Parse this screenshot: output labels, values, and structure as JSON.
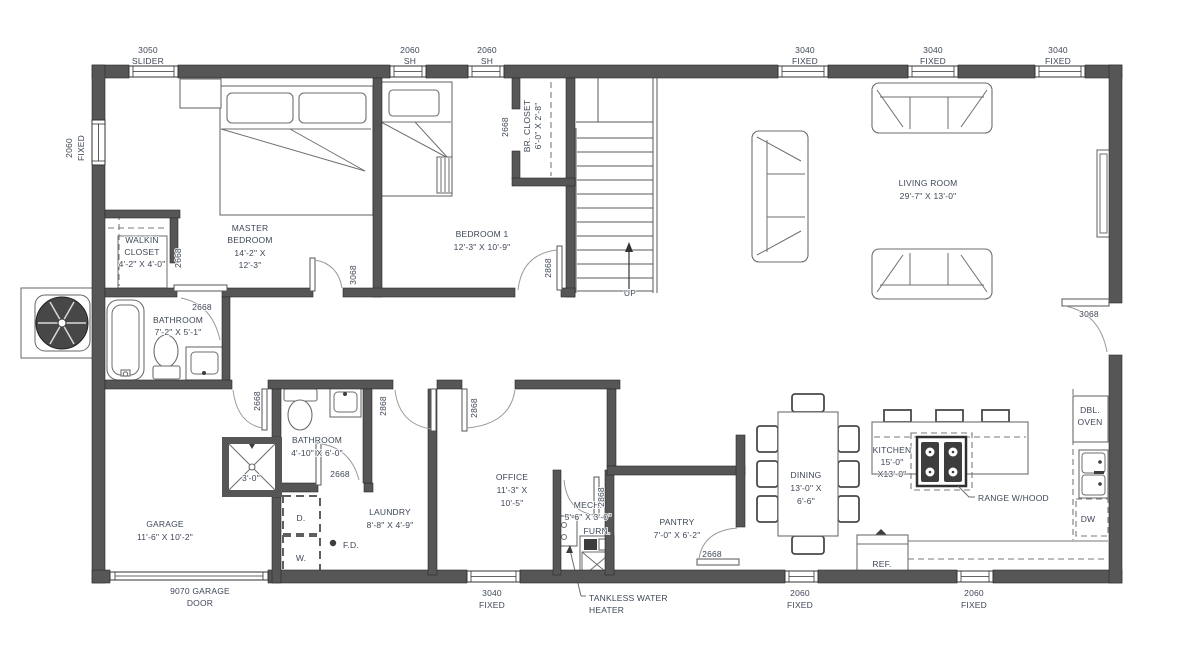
{
  "colors": {
    "wall": "#565656",
    "text": "#3e4757",
    "background": "#ffffff"
  },
  "windows": {
    "top": [
      {
        "size": "3050",
        "type": "SLIDER"
      },
      {
        "size": "2060",
        "type": "SH"
      },
      {
        "size": "2060",
        "type": "SH"
      },
      {
        "size": "3040",
        "type": "FIXED"
      },
      {
        "size": "3040",
        "type": "FIXED"
      },
      {
        "size": "3040",
        "type": "FIXED"
      }
    ],
    "left": {
      "size": "2060",
      "type": "FIXED"
    },
    "bottom": [
      {
        "size": "3040",
        "type": "FIXED"
      },
      {
        "size": "2060",
        "type": "FIXED"
      },
      {
        "size": "2060",
        "type": "FIXED"
      }
    ],
    "garage_door": {
      "line1": "9070 GARAGE",
      "line2": "DOOR"
    }
  },
  "rooms": {
    "master_bedroom": {
      "name1": "MASTER",
      "name2": "BEDROOM",
      "dim1": "14'-2\" X",
      "dim2": "12'-3\""
    },
    "walkin_closet": {
      "name1": "WALKIN",
      "name2": "CLOSET",
      "dim": "4'-2\" X 4'-0\""
    },
    "bedroom1": {
      "name": "BEDROOM 1",
      "dim": "12'-3\" X 10'-9\""
    },
    "br_closet": {
      "name": "BR. CLOSET",
      "dim": "6'-0\" X 2'-8\""
    },
    "bathroom1": {
      "name": "BATHROOM",
      "dim": "7'-2\" X 5'-1\""
    },
    "bathroom2": {
      "name": "BATHROOM",
      "dim": "4'-10\" X 6'-0\""
    },
    "living_room": {
      "name": "LIVING ROOM",
      "dim": "29'-7\" X 13'-0\""
    },
    "garage": {
      "name": "GARAGE",
      "dim": "11'-6\" X 10'-2\""
    },
    "laundry": {
      "name": "LAUNDRY",
      "dim": "8'-8\" X 4'-9\""
    },
    "office": {
      "name": "OFFICE",
      "dim1": "11'-3\" X",
      "dim2": "10'-5\""
    },
    "mech": {
      "name": "MECH.",
      "dim": "5'-6\" X 3'-0\""
    },
    "pantry": {
      "name": "PANTRY",
      "dim": "7'-0\" X 6'-2\""
    },
    "dining": {
      "name": "DINING",
      "dim1": "13'-0\" X",
      "dim2": "6'-6\""
    },
    "kitchen": {
      "name": "KITCHEN",
      "dim1": "15'-0\"",
      "dim2": "X13'-0\""
    }
  },
  "doors": {
    "walkin_closet": "2668",
    "master_bedroom": "3068",
    "br_closet": "2668",
    "bedroom1": "2868",
    "bathroom1": "2668",
    "garage_hall": "2668",
    "hall": "2868",
    "office": "2868",
    "bathroom2": "2668",
    "mech": "2868",
    "pantry": "2668",
    "living_room": "3068"
  },
  "stairs": {
    "up": "UP"
  },
  "fixtures": {
    "shower_dim": "3'-0\"",
    "dryer": "D.",
    "washer": "W.",
    "floor_drain": "F.D.",
    "furnace": "FURN.",
    "tankless1": "TANKLESS WATER",
    "tankless2": "HEATER",
    "range": "RANGE W/HOOD",
    "fridge": "REF.",
    "dbl_oven1": "DBL.",
    "dbl_oven2": "OVEN",
    "dishwasher": "DW"
  }
}
